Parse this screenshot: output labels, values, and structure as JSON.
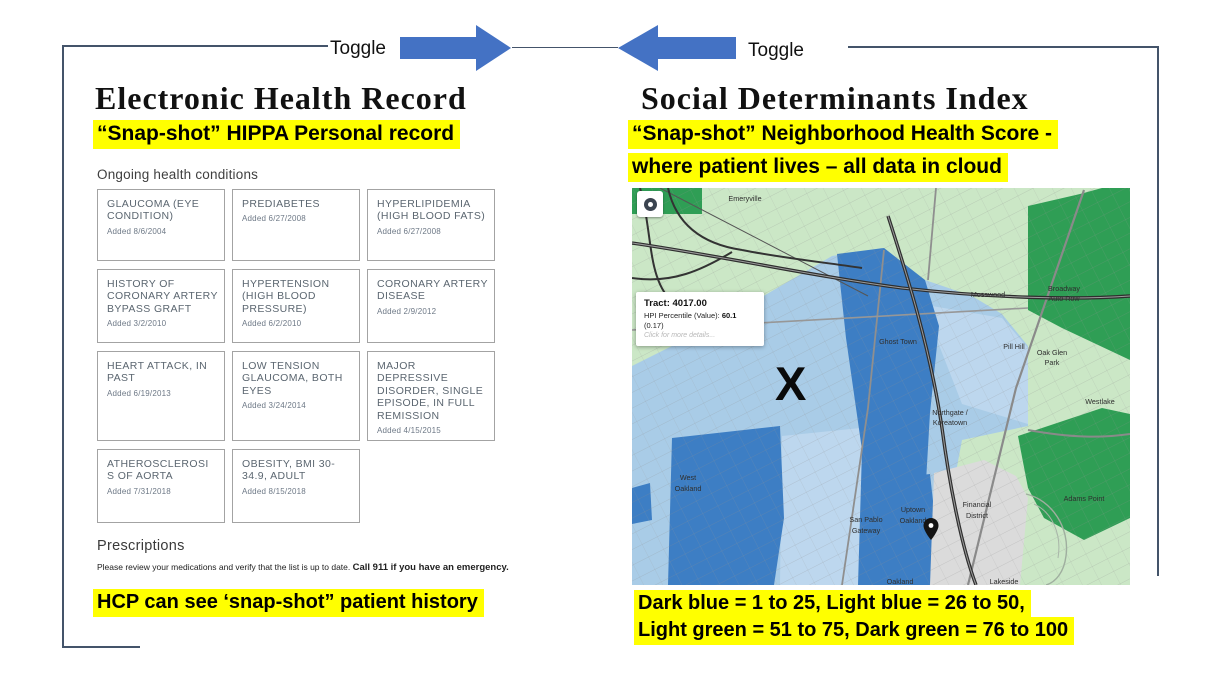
{
  "theme": {
    "highlight": "#ffff00",
    "arrow_blue": "#4472c4",
    "frame": "#44546a",
    "map_dark_blue": "#3d7ec4",
    "map_light_blue": "#a9cce7",
    "map_light_green": "#cbe7c6",
    "map_dark_green": "#2f9e55"
  },
  "toggle": {
    "left_label": "Toggle",
    "right_label": "Toggle"
  },
  "ehr": {
    "title": "Electronic Health Record",
    "subtitle": "“Snap-shot” HIPPA Personal record",
    "conditions_header": "Ongoing health conditions",
    "conditions": [
      {
        "name": "GLAUCOMA (EYE CONDITION)",
        "added": "Added 8/6/2004"
      },
      {
        "name": "PREDIABETES",
        "added": "Added 6/27/2008"
      },
      {
        "name": "HYPERLIPIDEMIA (HIGH BLOOD FATS)",
        "added": "Added 6/27/2008"
      },
      {
        "name": "HISTORY OF CORONARY ARTERY BYPASS GRAFT",
        "added": "Added 3/2/2010"
      },
      {
        "name": "HYPERTENSION (HIGH BLOOD PRESSURE)",
        "added": "Added 6/2/2010"
      },
      {
        "name": "CORONARY ARTERY DISEASE",
        "added": "Added 2/9/2012"
      },
      {
        "name": "HEART ATTACK, IN PAST",
        "added": "Added 6/19/2013"
      },
      {
        "name": "LOW TENSION GLAUCOMA, BOTH EYES",
        "added": "Added 3/24/2014"
      },
      {
        "name": "MAJOR DEPRESSIVE DISORDER, SINGLE EPISODE, IN FULL REMISSION",
        "added": "Added 4/15/2015"
      },
      {
        "name": "ATHEROSCLEROSI S OF AORTA",
        "added": "Added 7/31/2018"
      },
      {
        "name": "OBESITY, BMI 30-34.9, ADULT",
        "added": "Added 8/15/2018"
      }
    ],
    "prescriptions_header": "Prescriptions",
    "prescriptions_note": "Please review your medications and verify that the list is up to date. ",
    "prescriptions_note_bold": "Call 911 if you have an emergency.",
    "footer_note": "HCP can see ‘snap-shot” patient history"
  },
  "sdi": {
    "title": "Social Determinants Index",
    "subtitle_line1": "“Snap-shot” Neighborhood Health Score -",
    "subtitle_line2": "where patient lives – all data in cloud",
    "legend_line1": "Dark blue = 1 to 25, Light blue = 26 to 50,",
    "legend_line2": "Light green = 51 to 75, Dark green = 76 to 100",
    "map": {
      "tooltip": {
        "tract": "Tract: 4017.00",
        "hpi_label": "HPI Percentile (Value): ",
        "hpi_value": "60.1",
        "hpi_secondary": "(0.17)",
        "details_link": "Click for more details..."
      },
      "marker_x": "X",
      "labels": {
        "emeryville": "Emeryville",
        "mosswood": "Mosswood",
        "broadway_auto_row_1": "Broadway",
        "broadway_auto_row_2": "Auto Row",
        "ghost_town": "Ghost Town",
        "pill_hill": "Pill Hill",
        "oak_glen_1": "Oak Glen",
        "oak_glen_2": "Park",
        "westlake": "Westlake",
        "northgate_1": "Northgate /",
        "northgate_2": "Koreatown",
        "west_oakland_1": "West",
        "west_oakland_2": "Oakland",
        "san_pablo_1": "San Pablo",
        "san_pablo_2": "Gateway",
        "uptown_1": "Uptown",
        "uptown_2": "Oakland",
        "financial_1": "Financial",
        "financial_2": "District",
        "adams_point": "Adams Point",
        "oakland": "Oakland",
        "lakeside": "Lakeside"
      }
    }
  }
}
